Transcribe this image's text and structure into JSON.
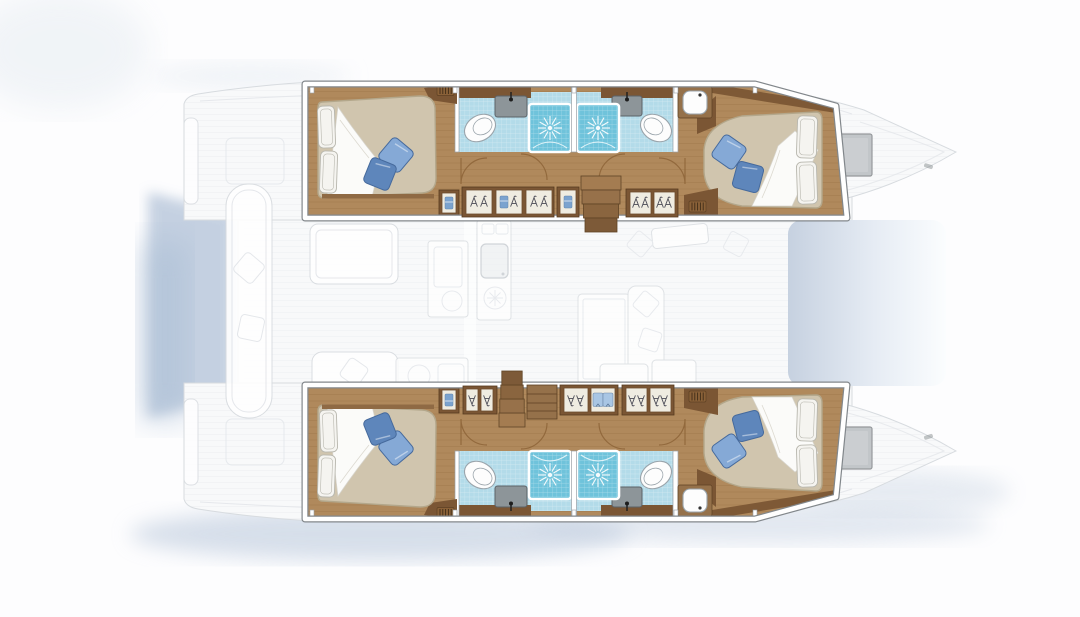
{
  "diagram": {
    "label": "Catamaran yacht accommodation layout plan, top-down view, bow to the right",
    "type": "yacht-floorplan",
    "vessel": "sailing catamaran",
    "layout_summary": {
      "double_cabins": 4,
      "bathrooms": 4,
      "shower_stalls": 4,
      "toilets": 4,
      "sinks": 4,
      "companionway_stairs": 2,
      "wardrobes_per_hull": "multiple hanging lockers with hangers, shirts and towels"
    }
  },
  "rooms": {
    "upper_hull": {
      "label": "Upper hull accommodation (highlighted interior)"
    },
    "lower_hull": {
      "label": "Lower hull accommodation (highlighted interior)"
    },
    "cabin_aft_upper": {
      "label": "Aft double cabin, upper hull, bed head to the left with white pillows and two blue cushions"
    },
    "cabin_fwd_upper": {
      "label": "Forward double cabin, upper hull, bed head to the right with white pillows and two blue cushions"
    },
    "bath_aft_upper": {
      "label": "Aft bathroom, upper hull: toilet, sink and tiled shower stall"
    },
    "bath_fwd_upper": {
      "label": "Forward bathroom, upper hull: tiled shower stall, sink and toilet"
    },
    "cabin_aft_lower": {
      "label": "Aft double cabin, lower hull"
    },
    "cabin_fwd_lower": {
      "label": "Forward double cabin, lower hull"
    },
    "bath_aft_lower": {
      "label": "Aft bathroom, lower hull"
    },
    "bath_fwd_lower": {
      "label": "Forward bathroom, lower hull"
    },
    "saloon": {
      "label": "Main-deck saloon with galley, dinette table and settee (ghosted)"
    },
    "cockpit": {
      "label": "Aft cockpit with bench seat and table (ghosted)"
    },
    "foredeck": {
      "label": "Forward cockpit / coachroof area (shaded blue panel)"
    },
    "bow_upper": {
      "label": "Upper hull bow with deck hatch (ghosted)"
    },
    "bow_lower": {
      "label": "Lower hull bow with deck hatch (ghosted)"
    }
  },
  "icons": {
    "shower_drain": "sunburst-icon",
    "hanger": "clothes-hanger-icon",
    "shirt": "folded-shirt-icon",
    "towel": "blue-towel-icon",
    "vent": "louvre-grille-icon",
    "stairs": "companionway-steps-icon"
  },
  "palette": {
    "bg": "#fdfdfe",
    "wood": "#b0895c",
    "woodLine": "#8d6437",
    "woodDark": "#7b5634",
    "woodMid": "#95714a",
    "mattress": "#d0c5ae",
    "mattressEdge": "#b3a78b",
    "pillow": "#f5f4f0",
    "pillowLine": "#b8b7ae",
    "blanket": "#fbfbf9",
    "cushionLight": "#85a9d6",
    "cushionDark": "#5e86bb",
    "cushionEdge": "#466a9c",
    "bathFloor": "#b3dbe9",
    "shower": "#6fc3db",
    "fixtureWhite": "#fdfdfd",
    "fixtureStroke": "#9aa4ab",
    "sink": "#8d9599",
    "sinkStroke": "#5b6268",
    "band": "#ffffff",
    "bandEdge": "#82878b",
    "panel": "#efece1",
    "panelStroke": "#6d4c2e",
    "hanger": "#4a4a55",
    "shirt": "#a9c6e4",
    "towel": "#7ba3cf",
    "ghostFill": "#f8f9fa",
    "ghostStroke": "#d7dbdf",
    "ghostDetail": "#e3e6ea",
    "shadow": "#b7c6da",
    "bowPanelDark": "#c6d1e0",
    "bowPanelLight": "#fbfdfe",
    "hatch": "#c2c6c9",
    "hatchStroke": "#96999c"
  }
}
